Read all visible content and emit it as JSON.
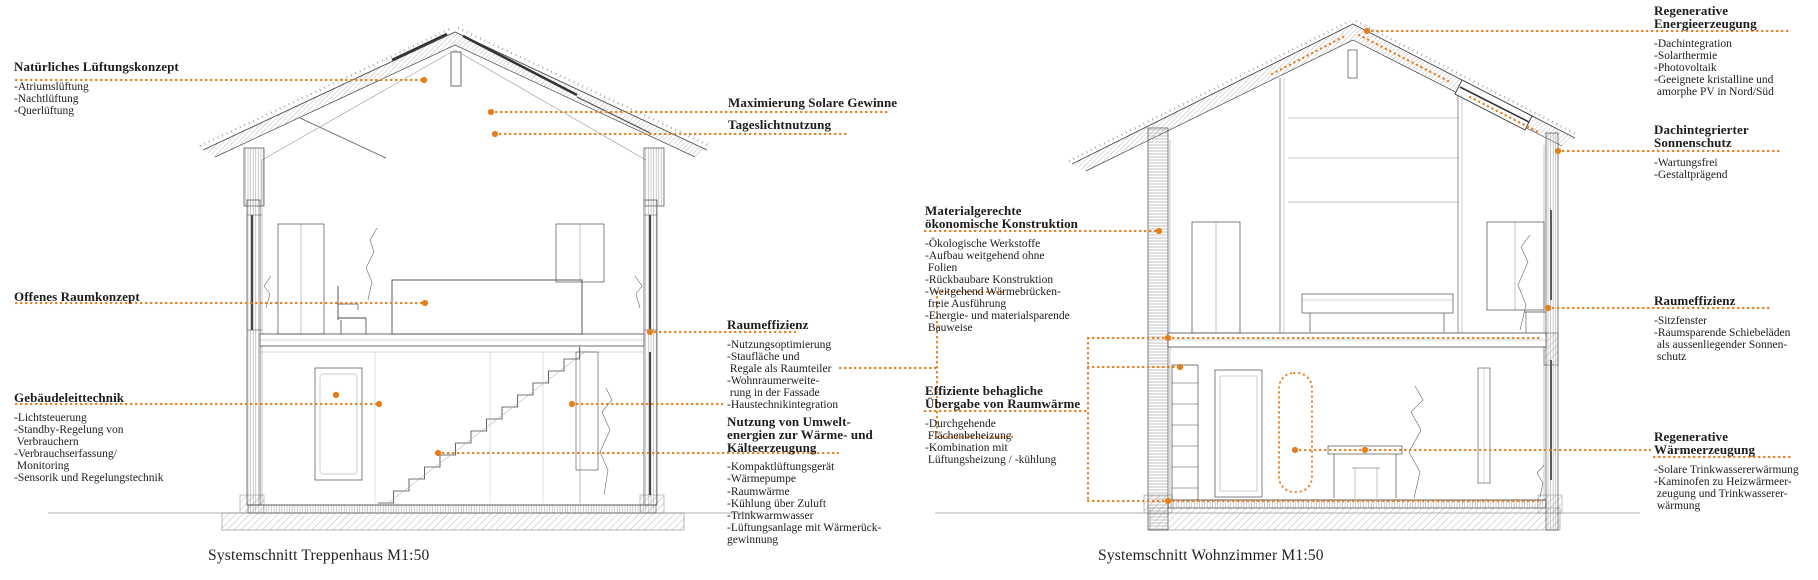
{
  "colors": {
    "accent": "#e87d1c",
    "ink": "#1c1c1c",
    "line": "#4a4a4a"
  },
  "captions": {
    "left": "Systemschnitt Treppenhaus M1:50",
    "right": "Systemschnitt Wohnzimmer M1:50"
  },
  "annotations": {
    "natural_ventilation": {
      "title": "Natürliches Lüftungskonzept",
      "items": [
        "-Atriumslüftung",
        "-Nachtlüftung",
        "-Querlüftung"
      ]
    },
    "open_space": {
      "title": "Offenes Raumkonzept",
      "items": []
    },
    "building_control": {
      "title": "Gebäudeleittechnik",
      "items": [
        "-Lichtsteuerung",
        "-Standby-Regelung von",
        " Verbrauchern",
        "-Verbrauchserfassung/",
        " Monitoring",
        "-Sensorik und Regelungstechnik"
      ]
    },
    "solar_gains": {
      "title": "Maximierung Solare Gewinne",
      "items": []
    },
    "daylight": {
      "title": "Tageslichtnutzung",
      "items": []
    },
    "space_efficiency_left": {
      "title": "Raumeffizienz",
      "items": [
        "-Nutzungsoptimierung",
        "-Staufläche und",
        " Regale als Raumteiler",
        "-Wohnraumerweite-",
        " rung in der Fassade",
        "-Haustechnikintegration"
      ]
    },
    "environmental_energy": {
      "title": "Nutzung von Umwelt-\nenergien zur Wärme- und\nKälteerzeugung",
      "items": [
        "-Kompaktlüftungsgerät",
        "-Wärmepumpe",
        "-Raumwärme",
        "-Kühlung über Zuluft",
        "-Trinkwarmwasser",
        "-Lüftungsanlage mit Wärmerück-",
        "gewinnung"
      ]
    },
    "material_construction": {
      "title": "Materialgerechte\nökonomische Konstruktion",
      "items": [
        "-Ökologische Werkstoffe",
        "-Aufbau weitgehend ohne",
        " Folien",
        "-Rückbaubare Konstruktion",
        "-Weitgehend Wärmebrücken-",
        " freie Ausführung",
        "-Energie- und materialsparende",
        " Bauweise"
      ]
    },
    "heat_transfer": {
      "title": "Effiziente behagliche\nÜbergabe von Raumwärme",
      "items": [
        "-Durchgehende",
        " Flächenbeheizung",
        "-Kombination mit",
        " Lüftungsheizung / -kühlung"
      ]
    },
    "renewable_power": {
      "title": "Regenerative\nEnergieerzeugung",
      "items": [
        "-Dachintegration",
        "-Solarthermie",
        "-Photovoltaik",
        "-Geeignete kristalline und",
        " amorphe PV in Nord/Süd"
      ]
    },
    "roof_sunshade": {
      "title": "Dachintegrierter\nSonnenschutz",
      "items": [
        "-Wartungsfrei",
        "-Gestaltprägend"
      ]
    },
    "space_efficiency_right": {
      "title": "Raumeffizienz",
      "items": [
        "-Sitzfenster",
        "-Raumsparende Schiebeläden",
        " als aussenliegender Sonnen-",
        " schutz"
      ]
    },
    "renewable_heat": {
      "title": "Regenerative\nWärmeerzeugung",
      "items": [
        "-Solare Trinkwassererwärmung",
        "-Kaminofen zu Heizwärmeer-",
        " zeugung und Trinkwasserer-",
        " wärmung"
      ]
    }
  }
}
